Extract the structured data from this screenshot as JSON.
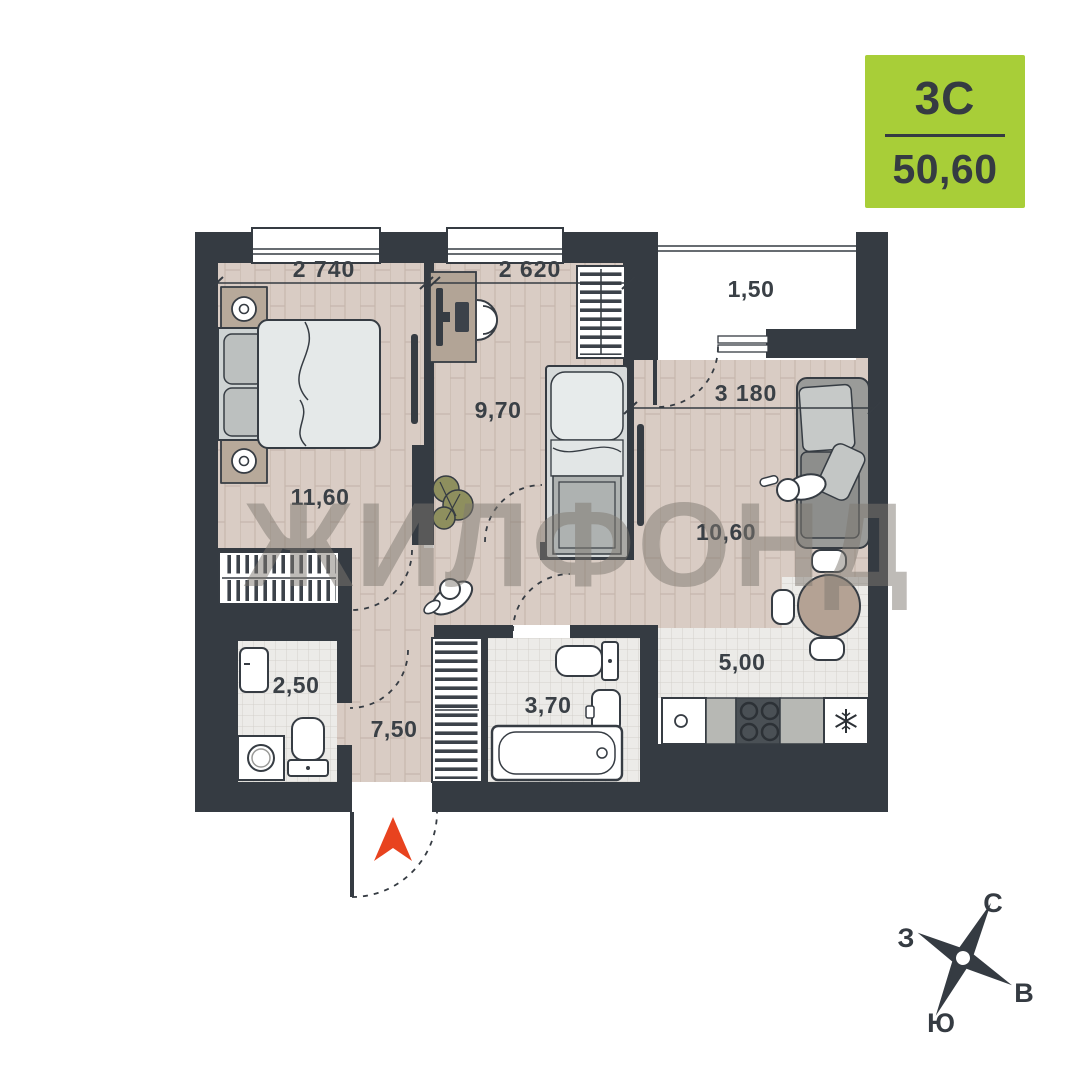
{
  "badge": {
    "plan_type": "3С",
    "area": "50,60",
    "bg_color": "#a8ce38",
    "text_color": "#353b42"
  },
  "watermark": "ЖИЛФОНД",
  "rooms": {
    "bedroom1": {
      "area": "11,60",
      "width_dim": "2 740"
    },
    "bedroom2": {
      "area": "9,70",
      "width_dim": "2 620"
    },
    "living": {
      "area": "10,60",
      "width_dim": "3 180"
    },
    "kitchen": {
      "area": "5,00"
    },
    "hall": {
      "area": "7,50"
    },
    "bathroom": {
      "area": "3,70"
    },
    "wc": {
      "area": "2,50"
    },
    "balcony": {
      "area": "1,50"
    }
  },
  "compass": {
    "north": "С",
    "east": "В",
    "south": "Ю",
    "west": "З"
  },
  "icons": {
    "entry_arrow": "▲",
    "freezer": "❄",
    "compass_star": "✦"
  },
  "colors": {
    "wall": "#353b42",
    "wood_floor": "#d9ccc4",
    "tile_floor": "#ecebe8",
    "entry_arrow": "#e8431f",
    "badge_bg": "#a8ce38",
    "watermark": "#7d776f"
  }
}
